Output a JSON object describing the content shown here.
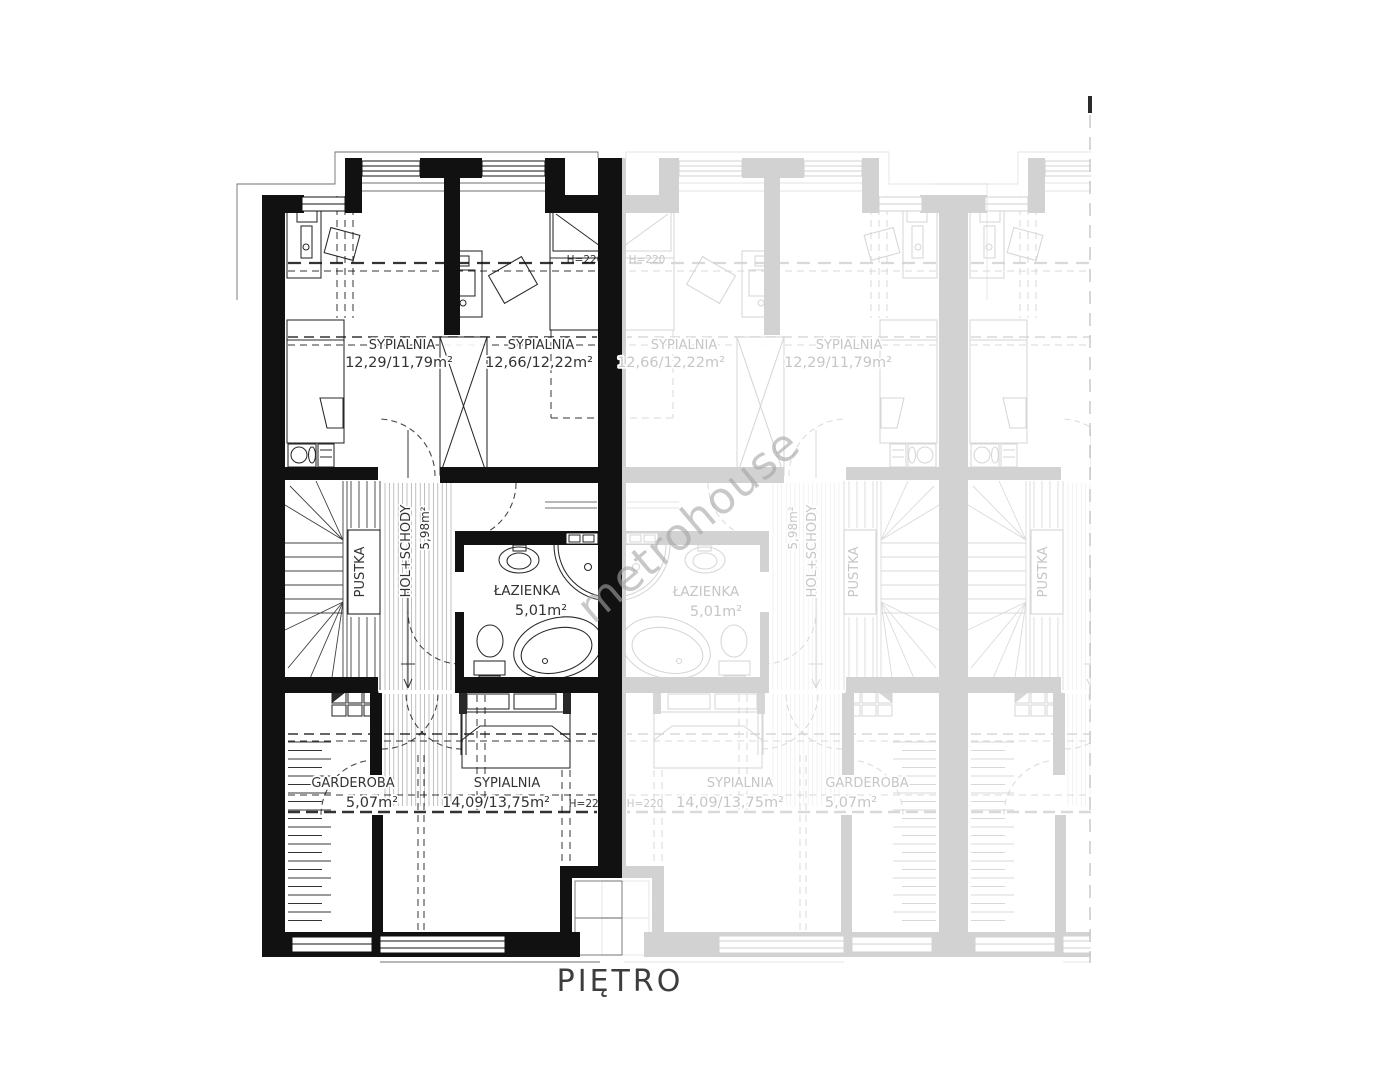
{
  "title": {
    "text": "PIĘTRO"
  },
  "watermark": {
    "text": "metrohouse"
  },
  "plan": {
    "colors": {
      "walls_main": "#111111",
      "walls_faded": "#d2d2d2",
      "label_main": "#333333",
      "label_faded": "#c6c6c6",
      "title": "#3d3d3d",
      "watermark": "#a5a5a5",
      "cut_line": "#c9c9c9",
      "cut_tick": "#2b2b2b"
    },
    "units": [
      {
        "id": "unit-main",
        "color_role": "walls_main"
      },
      {
        "id": "unit-adjacent-mirrored",
        "color_role": "walls_faded"
      },
      {
        "id": "unit-adjacent-partial",
        "color_role": "walls_faded"
      }
    ],
    "rooms": [
      {
        "name": "SYPIALNIA",
        "area": "12,29/11,79m²"
      },
      {
        "name": "SYPIALNIA",
        "area": "12,66/12,22m²"
      },
      {
        "name": "ŁAZIENKA",
        "area": "5,01m²"
      },
      {
        "name": "HOL+SCHODY",
        "area": "5,98m²"
      },
      {
        "name": "PUSTKA",
        "area": ""
      },
      {
        "name": "GARDEROBA",
        "area": "5,07m²"
      },
      {
        "name": "SYPIALNIA",
        "area": "14,09/13,75m²"
      }
    ],
    "height_note": "H=220",
    "labels": [
      {
        "id": "room-label-sypialnia-1",
        "text": "SYPIALNIA",
        "x": 402,
        "y": 349,
        "size": 13,
        "color": "label_main",
        "layer": "top"
      },
      {
        "id": "area-label-sypialnia-1",
        "text": "12,29/11,79m²",
        "x": 399,
        "y": 367,
        "size": 14.5,
        "color": "label_main",
        "layer": "top"
      },
      {
        "id": "room-label-sypialnia-2",
        "text": "SYPIALNIA",
        "x": 541,
        "y": 349,
        "size": 13,
        "color": "label_main",
        "layer": "top"
      },
      {
        "id": "area-label-sypialnia-2",
        "text": "12,66/12,22m²",
        "x": 539,
        "y": 367,
        "size": 14.5,
        "color": "label_main",
        "layer": "top"
      },
      {
        "id": "room-label-lazienka",
        "text": "ŁAZIENKA",
        "x": 527,
        "y": 595,
        "size": 13.5,
        "color": "label_main",
        "layer": "top"
      },
      {
        "id": "area-label-lazienka",
        "text": "5,01m²",
        "x": 541,
        "y": 615,
        "size": 14.5,
        "color": "label_main",
        "layer": "top"
      },
      {
        "id": "room-label-garderoba",
        "text": "GARDEROBA",
        "x": 353,
        "y": 787,
        "size": 13,
        "color": "label_main",
        "layer": "top"
      },
      {
        "id": "area-label-garderoba",
        "text": "5,07m²",
        "x": 372,
        "y": 807,
        "size": 14.5,
        "color": "label_main",
        "layer": "top"
      },
      {
        "id": "room-label-sypialnia-3",
        "text": "SYPIALNIA",
        "x": 507,
        "y": 787,
        "size": 13,
        "color": "label_main",
        "layer": "top"
      },
      {
        "id": "area-label-sypialnia-3",
        "text": "14,09/13,75m²",
        "x": 496,
        "y": 807,
        "size": 14.5,
        "color": "label_main",
        "layer": "top"
      },
      {
        "id": "room-label-pustka",
        "text": "PUSTKA",
        "x": 364,
        "y": 572,
        "rot": -90,
        "size": 13,
        "color": "label_main",
        "layer": "top"
      },
      {
        "id": "room-label-hol-schody",
        "text": "HOL+SCHODY",
        "x": 410,
        "y": 551,
        "rot": -90,
        "size": 13,
        "color": "label_main",
        "layer": "top"
      },
      {
        "id": "area-label-hol-schody",
        "text": "5,98m²",
        "x": 429,
        "y": 528,
        "rot": -90,
        "size": 12,
        "color": "label_main",
        "layer": "top"
      },
      {
        "id": "height-label-top",
        "text": "H=220",
        "x": 585,
        "y": 263,
        "size": 10.5,
        "color": "label_main",
        "layer": "under"
      },
      {
        "id": "height-label-bottom",
        "text": "H=220",
        "x": 587,
        "y": 807,
        "size": 10.5,
        "color": "label_main",
        "layer": "under"
      },
      {
        "id": "faded-room-label-sypialnia-1",
        "text": "SYPIALNIA",
        "x": 684,
        "y": 349,
        "size": 13,
        "color": "label_faded",
        "layer": "top"
      },
      {
        "id": "faded-area-label-sypialnia-1",
        "text": "12,66/12,22m²",
        "x": 671,
        "y": 367,
        "size": 14.5,
        "color": "label_faded",
        "layer": "top"
      },
      {
        "id": "faded-room-label-sypialnia-2",
        "text": "SYPIALNIA",
        "x": 849,
        "y": 349,
        "size": 13,
        "color": "label_faded",
        "layer": "top"
      },
      {
        "id": "faded-area-label-sypialnia-2",
        "text": "12,29/11,79m²",
        "x": 838,
        "y": 367,
        "size": 14.5,
        "color": "label_faded",
        "layer": "top"
      },
      {
        "id": "faded-room-label-lazienka",
        "text": "ŁAZIENKA",
        "x": 706,
        "y": 596,
        "size": 13.5,
        "color": "label_faded",
        "layer": "top"
      },
      {
        "id": "faded-area-label-lazienka",
        "text": "5,01m²",
        "x": 716,
        "y": 616,
        "size": 14.5,
        "color": "label_faded",
        "layer": "top"
      },
      {
        "id": "faded-room-label-sypialnia-3",
        "text": "SYPIALNIA",
        "x": 740,
        "y": 787,
        "size": 13,
        "color": "label_faded",
        "layer": "top"
      },
      {
        "id": "faded-area-label-sypialnia-3",
        "text": "14,09/13,75m²",
        "x": 730,
        "y": 807,
        "size": 14.5,
        "color": "label_faded",
        "layer": "top"
      },
      {
        "id": "faded-room-label-garderoba",
        "text": "GARDEROBA",
        "x": 867,
        "y": 787,
        "size": 13,
        "color": "label_faded",
        "layer": "top"
      },
      {
        "id": "faded-area-label-garderoba",
        "text": "5,07m²",
        "x": 851,
        "y": 807,
        "size": 14.5,
        "color": "label_faded",
        "layer": "top"
      },
      {
        "id": "faded-room-label-pustka",
        "text": "PUSTKA",
        "x": 858,
        "y": 572,
        "rot": -90,
        "size": 13,
        "color": "label_faded",
        "layer": "top"
      },
      {
        "id": "faded-room-label-hol-schody",
        "text": "HOL+SCHODY",
        "x": 816,
        "y": 551,
        "rot": -90,
        "size": 13,
        "color": "label_faded",
        "layer": "top"
      },
      {
        "id": "faded-area-label-hol-schody",
        "text": "5,98m²",
        "x": 797,
        "y": 528,
        "rot": -90,
        "size": 12,
        "color": "label_faded",
        "layer": "top"
      },
      {
        "id": "faded-height-label-top",
        "text": "H=220",
        "x": 647,
        "y": 263,
        "size": 10.5,
        "color": "label_faded",
        "layer": "top"
      },
      {
        "id": "faded-height-label-bottom",
        "text": "H=220",
        "x": 645,
        "y": 807,
        "size": 10.5,
        "color": "label_faded",
        "layer": "top"
      },
      {
        "id": "faded-room-label-pustka-unit3",
        "text": "PUSTKA",
        "x": 1047,
        "y": 572,
        "rot": -90,
        "size": 13,
        "color": "label_faded",
        "layer": "top"
      }
    ]
  }
}
